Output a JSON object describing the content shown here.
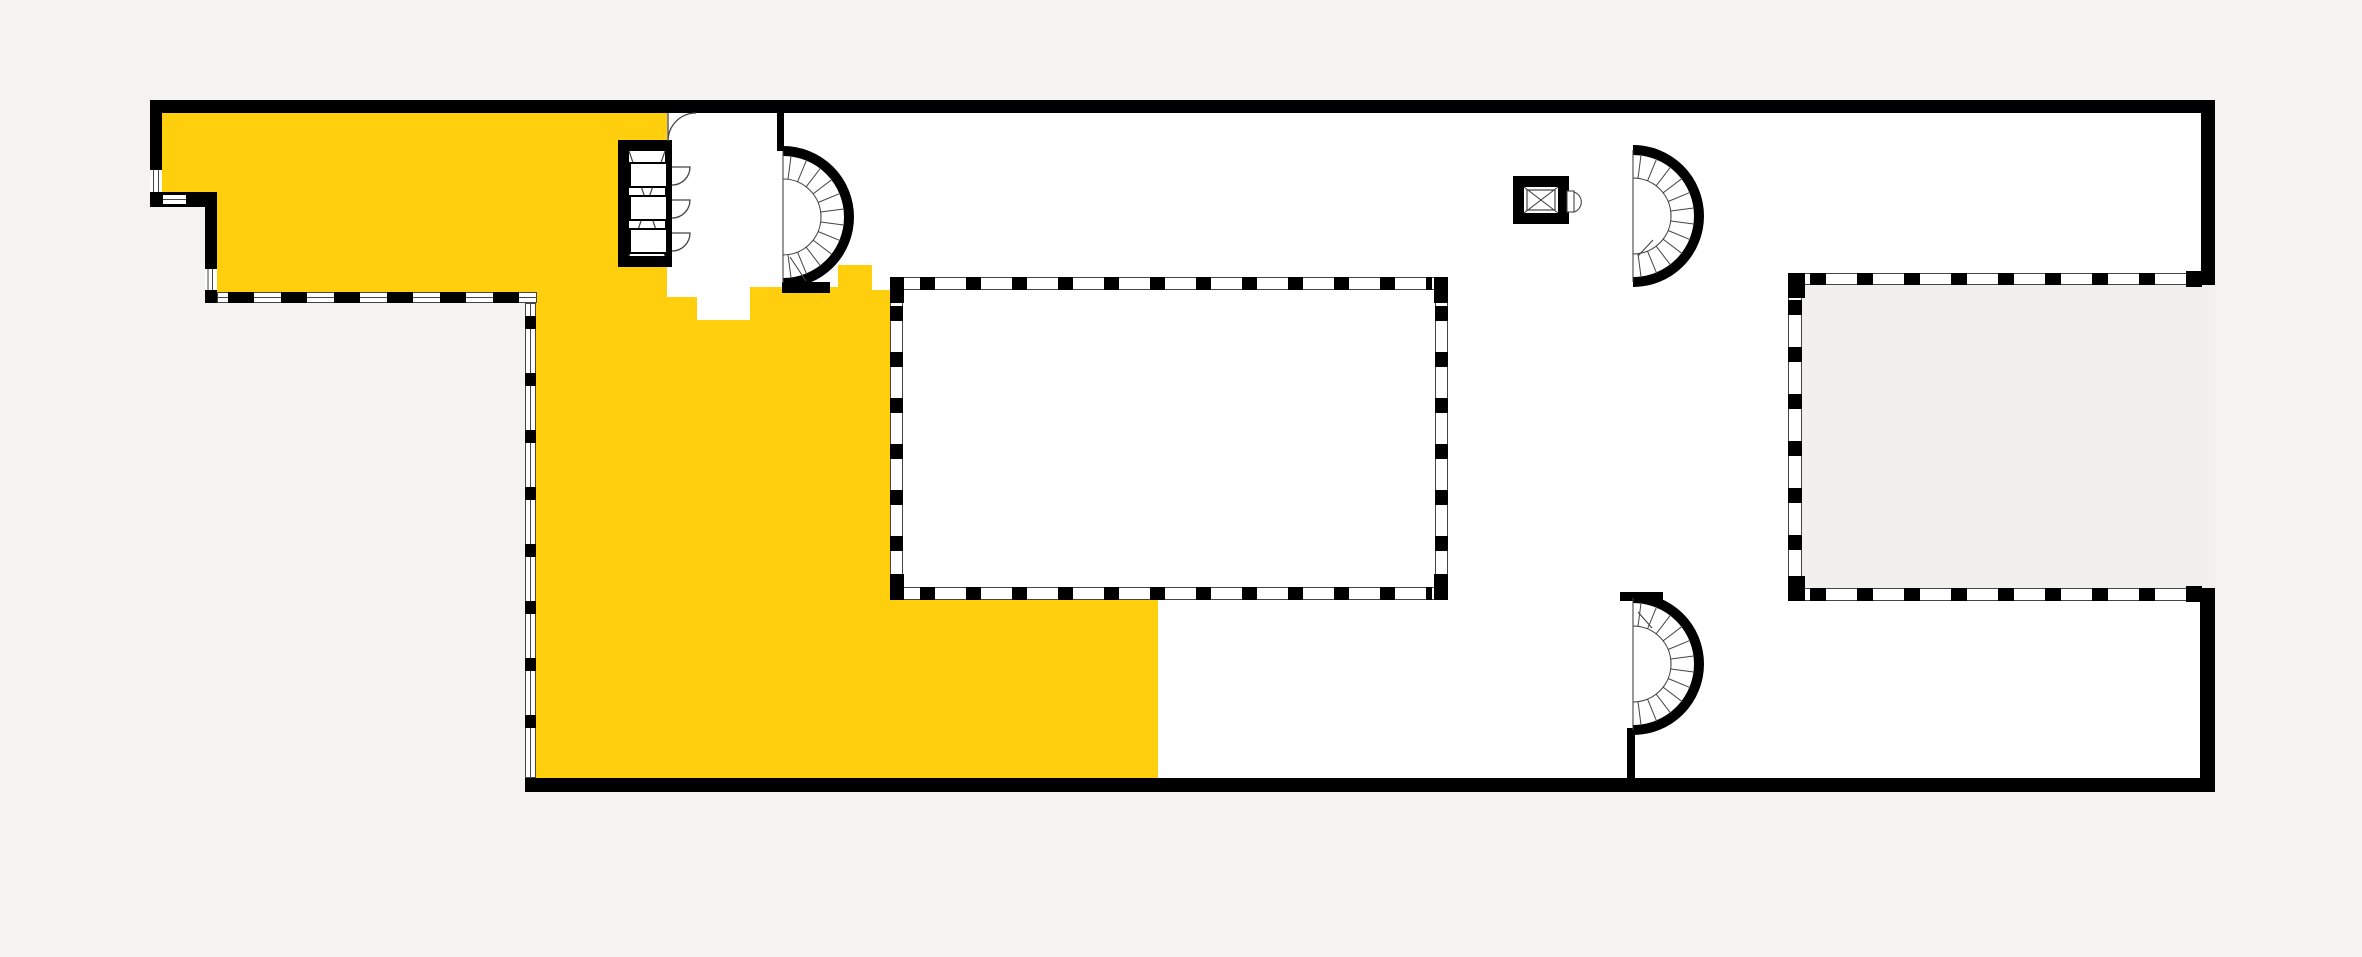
{
  "title": "Building floor plan with highlighted unit",
  "palette": {
    "background": "#f4f3f1",
    "floor": "#ffffff",
    "wall": "#000000",
    "highlight": "#ffce0d",
    "courtyard": "#f1f0ed",
    "thin_line": "#454545"
  },
  "plan": {
    "highlighted_unit": {
      "name": "unit-highlight",
      "color": "#ffce0d"
    },
    "stairs": [
      {
        "name": "spiral-stair-west",
        "cx": 783,
        "cy": 217,
        "r_outer": 66,
        "r_inner": 38,
        "r_tread": 62,
        "treads": 12
      },
      {
        "name": "spiral-stair-northeast",
        "cx": 1633,
        "cy": 216,
        "r_outer": 66,
        "r_inner": 38,
        "r_tread": 62,
        "treads": 12
      },
      {
        "name": "spiral-stair-southeast",
        "cx": 1633,
        "cy": 664,
        "r_outer": 66,
        "r_inner": 38,
        "r_tread": 62,
        "treads": 12
      }
    ],
    "elevators": [
      {
        "name": "elevator-bank",
        "cars": 3
      },
      {
        "name": "single-elevator",
        "cars": 1
      }
    ],
    "rooms": [
      {
        "name": "core-room"
      },
      {
        "name": "courtyard"
      }
    ]
  }
}
